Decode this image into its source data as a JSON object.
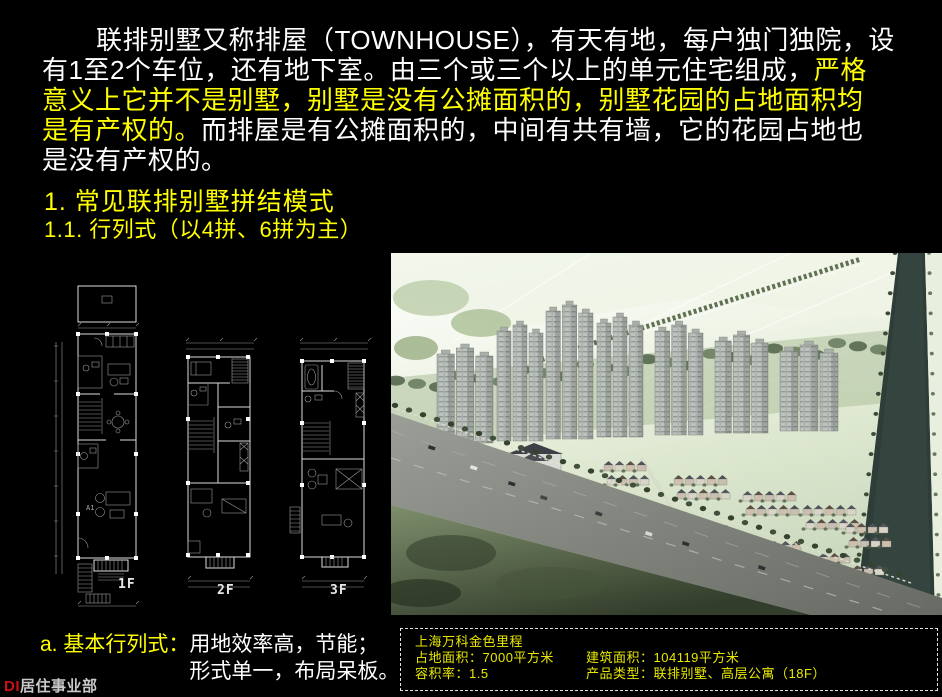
{
  "paragraph": {
    "line1": "联排别墅又称排屋（TOWNHOUSE），有天有地，每户独门独院，设",
    "line2_white": "有1至2个车位，还有地下室。由三个或三个以上的单元住宅组成，",
    "line2_yellow": "严格",
    "line3_yellow": "意义上它并不是别墅，别墅是没有公摊面积的，别墅花园的占地面积均",
    "line4_yellow": "是有产权的。",
    "line4_white": "而排屋是有公摊面积的，中间有共有墙，它的花园占地也",
    "line5_white": "是没有产权的。"
  },
  "headings": {
    "section": "1. 常见联排别墅拼结模式",
    "subsection": "1.1. 行列式（以4拼、6拼为主）"
  },
  "floor_plans": {
    "label_1f": "1F",
    "label_2f": "2F",
    "label_3f": "3F"
  },
  "note": {
    "label": "a. 基本行列式：",
    "line1": "用地效率高，节能；",
    "line2": "形式单一，布局呆板。"
  },
  "project_info": {
    "title": "上海万科金色里程",
    "rows": [
      {
        "left": "占地面积：7000平方米",
        "right": "建筑面积：104119平方米"
      },
      {
        "left": "容积率：1.5",
        "right": "产品类型：联排别墅、高层公寓（18F）"
      }
    ]
  },
  "footer": {
    "brand": "DI",
    "department": "居住事业部"
  },
  "colors": {
    "background": "#000000",
    "text_white": "#ffffff",
    "highlight_yellow": "#ffff00",
    "info_yellow": "#e9e900",
    "brand_red": "#cc1111"
  }
}
